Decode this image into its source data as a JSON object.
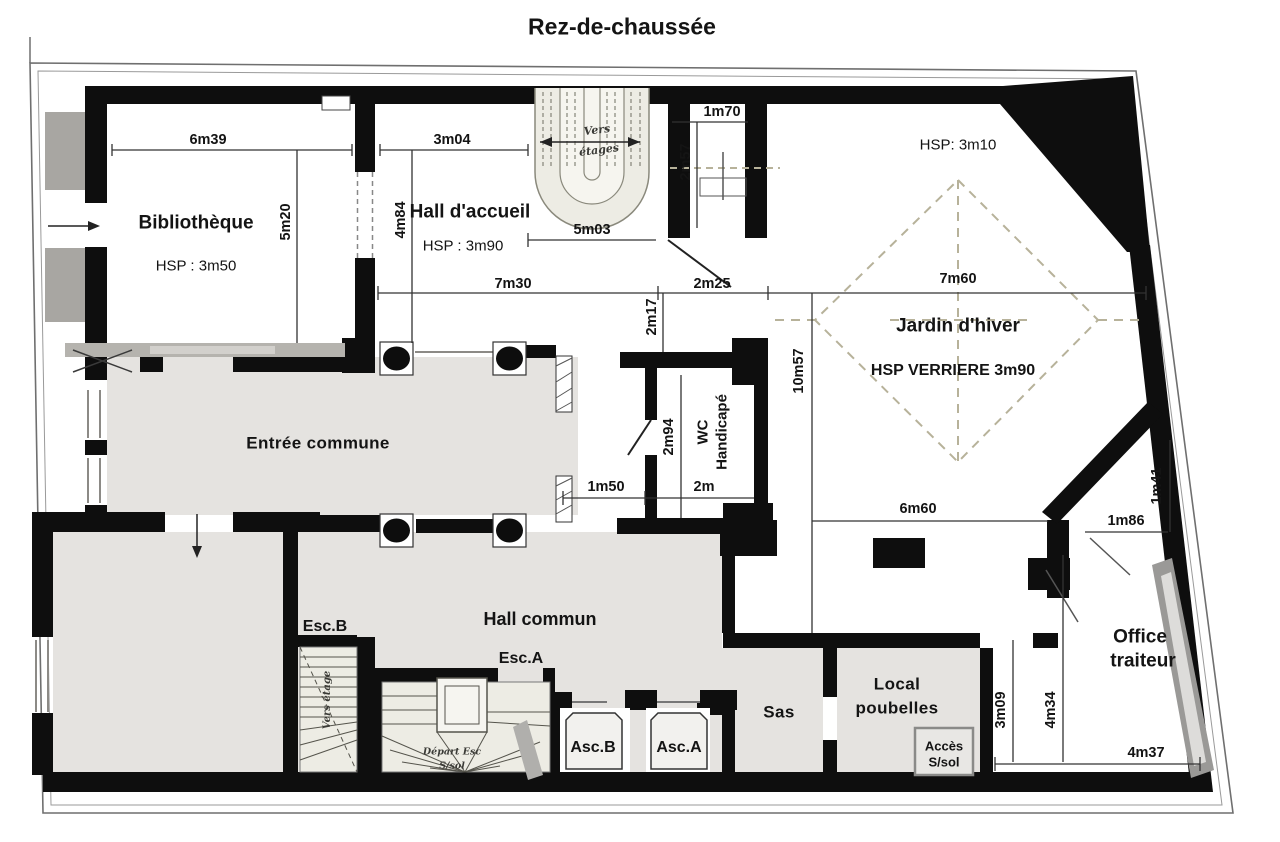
{
  "title": "Rez-de-chaussée",
  "rooms": {
    "bibliotheque": "Bibliothèque",
    "bibliotheque_hsp": "HSP : 3m50",
    "hall_accueil": "Hall d'accueil",
    "hall_accueil_hsp": "HSP : 3m90",
    "jardin": "Jardin d'hiver",
    "jardin_hsp": "HSP: 3m10",
    "jardin_verriere": "HSP VERRIERE 3m90",
    "entree": "Entrée commune",
    "hall_commun": "Hall commun",
    "wc_line1": "WC",
    "wc_line2": "Handicapé",
    "sas": "Sas",
    "local_line1": "Local",
    "local_line2": "poubelles",
    "acces_line1": "Accès",
    "acces_line2": "S/sol",
    "office_line1": "Office",
    "office_line2": "traiteur",
    "esc_b": "Esc.B",
    "esc_a": "Esc.A",
    "asc_b": "Asc.B",
    "asc_a": "Asc.A"
  },
  "dimensions": {
    "h6m39": "6m39",
    "h3m04": "3m04",
    "v5m20": "5m20",
    "v4m84": "4m84",
    "h5m03": "5m03",
    "h1m70": "1m70",
    "v2m57": "2m57",
    "h7m30": "7m30",
    "h2m25": "2m25",
    "h7m60": "7m60",
    "v2m17": "2m17",
    "v10m57": "10m57",
    "v2m94": "2m94",
    "h1m50": "1m50",
    "h2m": "2m",
    "h6m60": "6m60",
    "h1m86": "1m86",
    "v1m41": "1m41",
    "v3m09": "3m09",
    "v4m34": "4m34",
    "h4m37": "4m37"
  },
  "annotations": {
    "vers": "Vers",
    "etages": "étages",
    "vers_etage": "Vers étage",
    "depart_esc": "Départ Esc",
    "s_sol": "S/sol"
  },
  "colors": {
    "wall": "#0e0e0e",
    "room_gray": "#e5e3e0",
    "stair_beige": "#edece4",
    "verriere_dash": "#b7b29a",
    "reveal_gray": "#a8a6a2"
  }
}
